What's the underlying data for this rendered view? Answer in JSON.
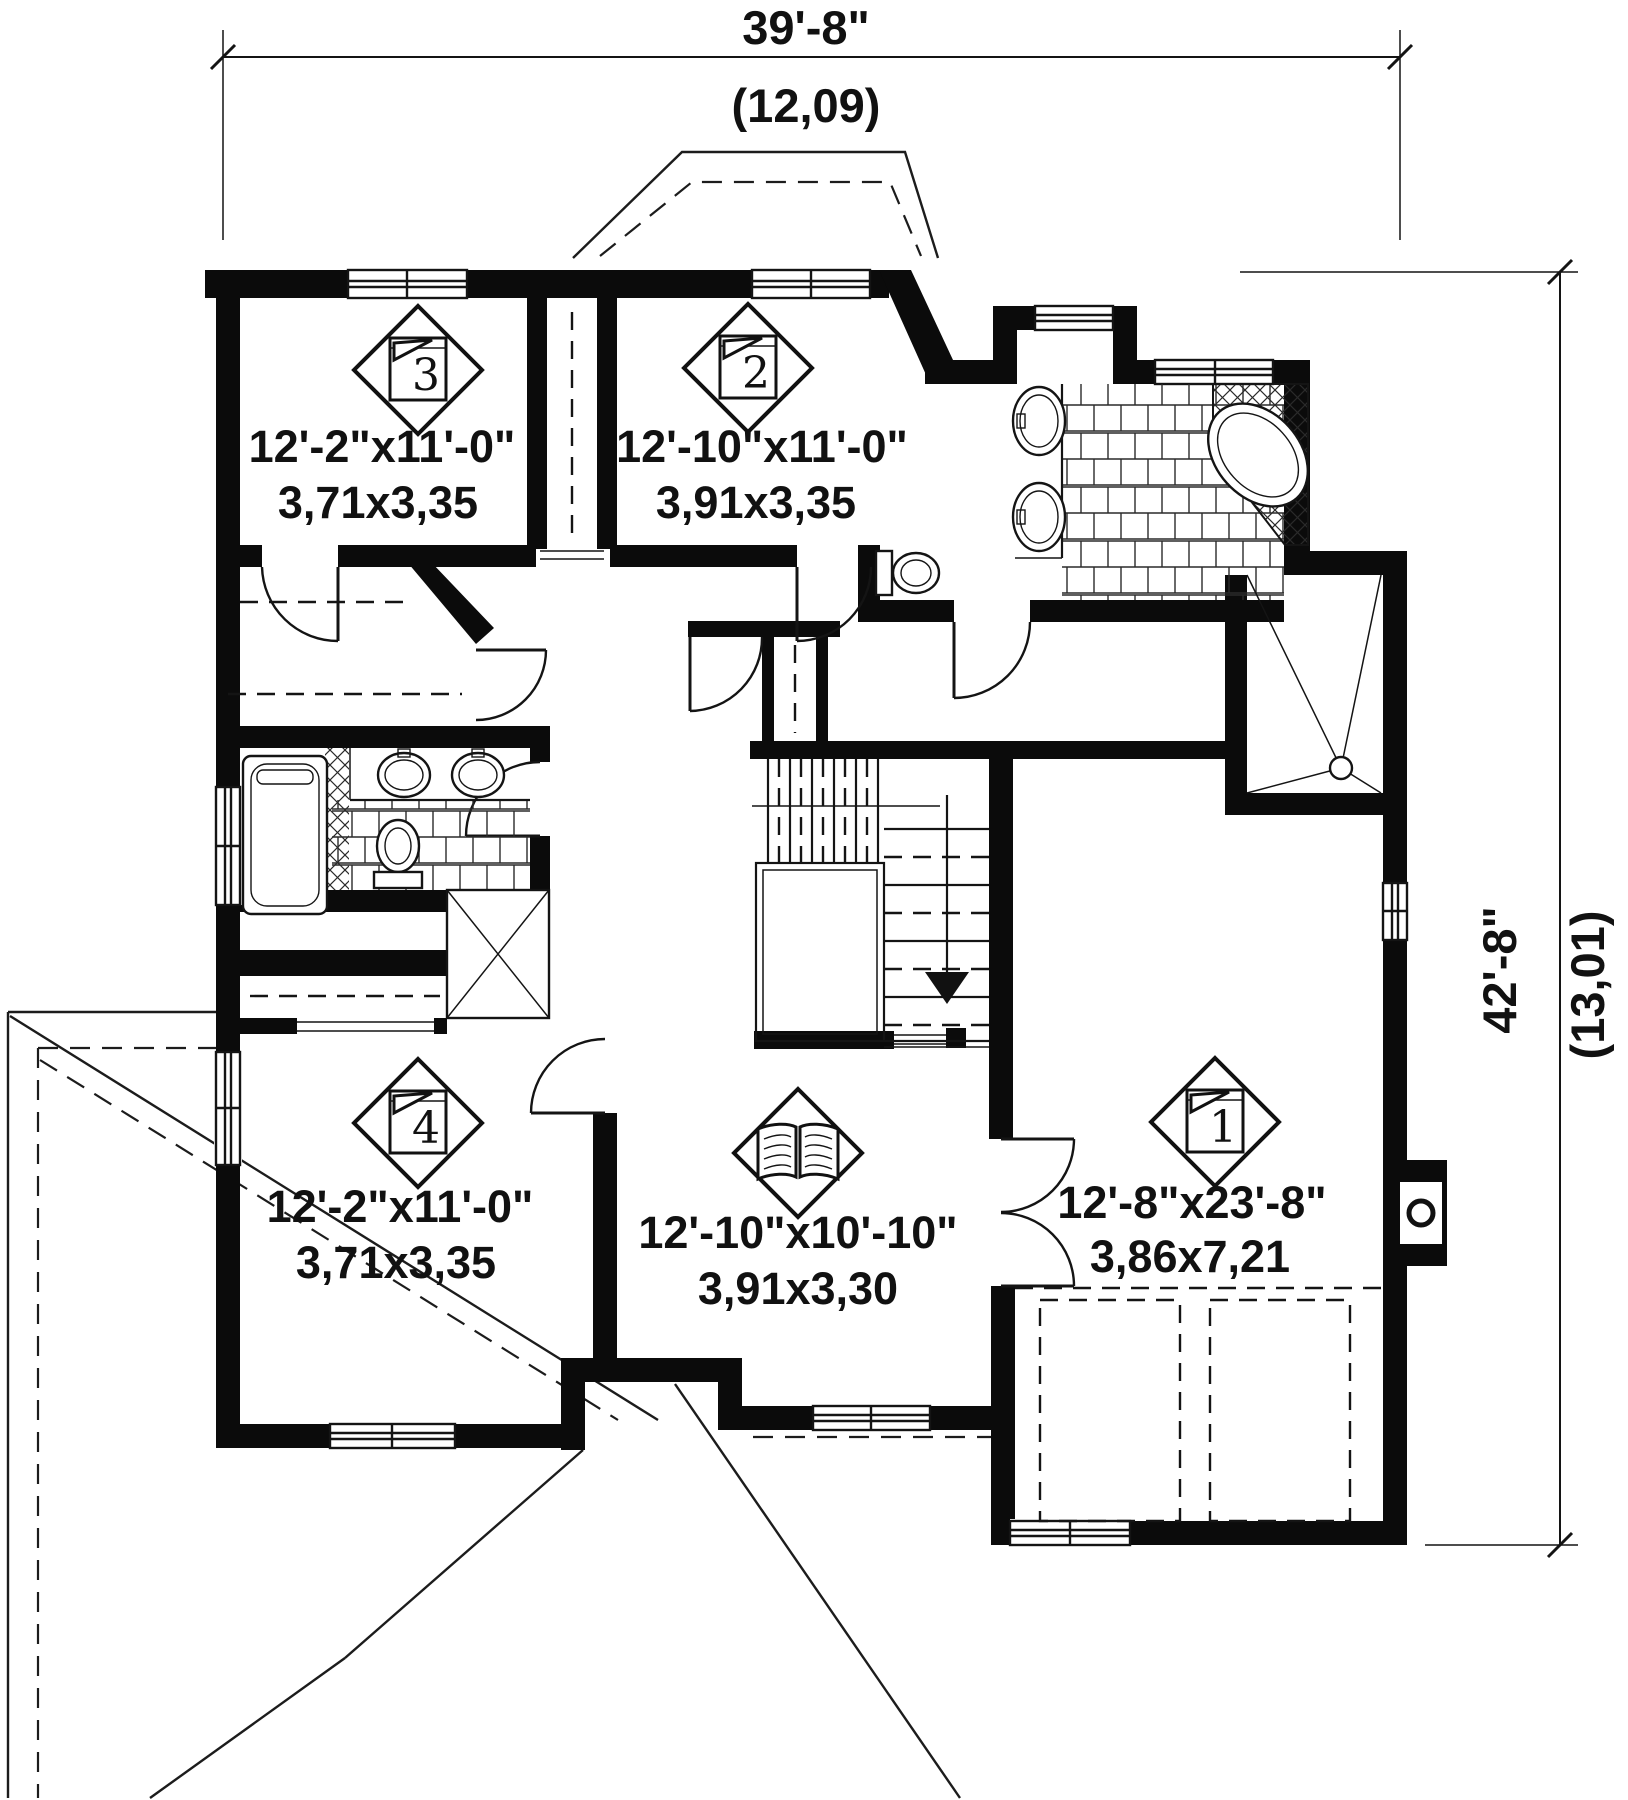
{
  "plan": {
    "type": "floor-plan",
    "dimensions": {
      "top": {
        "imperial": "39'-8\"",
        "metric": "(12,09)"
      },
      "right": {
        "imperial": "42'-8\"",
        "metric": "(13,01)"
      }
    },
    "rooms": {
      "bedroom3": {
        "marker": "3",
        "imperial": "12'-2\"x11'-0\"",
        "metric": "3,71x3,35"
      },
      "bedroom2": {
        "marker": "2",
        "imperial": "12'-10\"x11'-0\"",
        "metric": "3,91x3,35"
      },
      "bedroom4": {
        "marker": "4",
        "imperial": "12'-2\"x11'-0\"",
        "metric": "3,71x3,35"
      },
      "study": {
        "imperial": "12'-10\"x10'-10\"",
        "metric": "3,91x3,30"
      },
      "bedroom1": {
        "marker": "1",
        "imperial": "12'-8\"x23'-8\"",
        "metric": "3,86x7,21"
      }
    },
    "icons": {
      "bedroom_marker": "bed-icon",
      "study_marker": "book-icon"
    }
  }
}
